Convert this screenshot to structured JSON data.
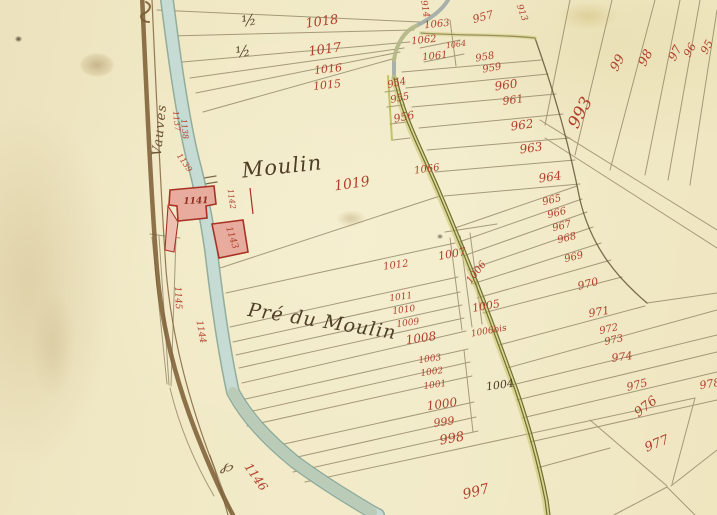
{
  "map": {
    "kind": "historical cadastral plan (manuscript)",
    "colors": {
      "paper": "#f0e8c5",
      "parcel_number_red": "#b1402c",
      "ink_brown": "#4e3e26",
      "river_blue": "#c3d9d1",
      "road_brown": "#7a5c33",
      "path_olive": "#6f7030",
      "building_pink": "#e7ac9d",
      "building_red": "#a93226"
    },
    "place_labels": {
      "moulin": "Moulin",
      "pre_du_moulin": "Pré du Moulin",
      "vauves": "Vauves"
    },
    "labels": [
      {
        "t": "Moulin",
        "x": 282,
        "y": 167,
        "r": -6,
        "s": 21,
        "c": "c-ink",
        "n": "place-label-moulin",
        "cls": "script"
      },
      {
        "t": "Pré du Moulin",
        "x": 322,
        "y": 322,
        "r": 9,
        "s": 19,
        "c": "c-ink",
        "n": "place-label-pre-du-moulin",
        "cls": "script"
      },
      {
        "t": "Vauves",
        "x": 160,
        "y": 130,
        "r": -84,
        "s": 13,
        "c": "c-brn",
        "n": "place-label-vauves",
        "cls": "script"
      },
      {
        "t": "½",
        "x": 249,
        "y": 21,
        "r": -10,
        "s": 15,
        "c": "c-ink",
        "n": "fraction-label"
      },
      {
        "t": "½",
        "x": 243,
        "y": 52,
        "r": -10,
        "s": 15,
        "c": "c-ink",
        "n": "fraction-label"
      },
      {
        "t": "℘",
        "x": 227,
        "y": 466,
        "r": 15,
        "s": 16,
        "c": "c-brn",
        "n": "flow-mark"
      },
      {
        "t": "1018",
        "x": 322,
        "y": 22,
        "r": -8,
        "s": 13,
        "c": "c-red",
        "n": "parcel-1018"
      },
      {
        "t": "1017",
        "x": 325,
        "y": 50,
        "r": -8,
        "s": 13,
        "c": "c-red",
        "n": "parcel-1017"
      },
      {
        "t": "1016",
        "x": 328,
        "y": 69,
        "r": -6,
        "s": 11,
        "c": "c-red",
        "n": "parcel-1016"
      },
      {
        "t": "1015",
        "x": 327,
        "y": 85,
        "r": -6,
        "s": 11,
        "c": "c-red",
        "n": "parcel-1015"
      },
      {
        "t": "914",
        "x": 424,
        "y": 9,
        "r": 80,
        "s": 9,
        "c": "c-red",
        "n": "parcel-914"
      },
      {
        "t": "913",
        "x": 521,
        "y": 13,
        "r": 70,
        "s": 9,
        "c": "c-red",
        "n": "parcel-913"
      },
      {
        "t": "957",
        "x": 483,
        "y": 17,
        "r": -15,
        "s": 11,
        "c": "c-red",
        "n": "parcel-957"
      },
      {
        "t": "1063",
        "x": 437,
        "y": 25,
        "r": -6,
        "s": 10,
        "c": "c-red",
        "n": "parcel-1063"
      },
      {
        "t": "1062",
        "x": 424,
        "y": 41,
        "r": -6,
        "s": 10,
        "c": "c-red",
        "n": "parcel-1062"
      },
      {
        "t": "1064",
        "x": 456,
        "y": 45,
        "r": -8,
        "s": 8,
        "c": "c-red",
        "n": "parcel-1064"
      },
      {
        "t": "1061",
        "x": 435,
        "y": 57,
        "r": -6,
        "s": 10,
        "c": "c-red",
        "n": "parcel-1061"
      },
      {
        "t": "954",
        "x": 397,
        "y": 84,
        "r": -12,
        "s": 10,
        "c": "c-red",
        "n": "parcel-954"
      },
      {
        "t": "955",
        "x": 400,
        "y": 99,
        "r": -12,
        "s": 10,
        "c": "c-red",
        "n": "parcel-955"
      },
      {
        "t": "956",
        "x": 404,
        "y": 117,
        "r": -12,
        "s": 11,
        "c": "c-red",
        "n": "parcel-956"
      },
      {
        "t": "958",
        "x": 485,
        "y": 58,
        "r": -10,
        "s": 10,
        "c": "c-red",
        "n": "parcel-958"
      },
      {
        "t": "959",
        "x": 492,
        "y": 69,
        "r": -10,
        "s": 10,
        "c": "c-red",
        "n": "parcel-959"
      },
      {
        "t": "960",
        "x": 506,
        "y": 85,
        "r": -8,
        "s": 12,
        "c": "c-red",
        "n": "parcel-960"
      },
      {
        "t": "961",
        "x": 513,
        "y": 100,
        "r": -8,
        "s": 11,
        "c": "c-red",
        "n": "parcel-961"
      },
      {
        "t": "962",
        "x": 522,
        "y": 125,
        "r": -8,
        "s": 12,
        "c": "c-red",
        "n": "parcel-962"
      },
      {
        "t": "963",
        "x": 531,
        "y": 148,
        "r": -8,
        "s": 12,
        "c": "c-red",
        "n": "parcel-963"
      },
      {
        "t": "964",
        "x": 550,
        "y": 177,
        "r": -8,
        "s": 12,
        "c": "c-red",
        "n": "parcel-964"
      },
      {
        "t": "965",
        "x": 552,
        "y": 201,
        "r": -14,
        "s": 10,
        "c": "c-red",
        "n": "parcel-965"
      },
      {
        "t": "966",
        "x": 557,
        "y": 214,
        "r": -14,
        "s": 10,
        "c": "c-red",
        "n": "parcel-966"
      },
      {
        "t": "967",
        "x": 562,
        "y": 227,
        "r": -14,
        "s": 10,
        "c": "c-red",
        "n": "parcel-967"
      },
      {
        "t": "968",
        "x": 567,
        "y": 239,
        "r": -14,
        "s": 10,
        "c": "c-red",
        "n": "parcel-968"
      },
      {
        "t": "969",
        "x": 574,
        "y": 258,
        "r": -14,
        "s": 10,
        "c": "c-red",
        "n": "parcel-969"
      },
      {
        "t": "970",
        "x": 588,
        "y": 284,
        "r": -14,
        "s": 11,
        "c": "c-red",
        "n": "parcel-970"
      },
      {
        "t": "971",
        "x": 599,
        "y": 312,
        "r": -10,
        "s": 11,
        "c": "c-red",
        "n": "parcel-971"
      },
      {
        "t": "972",
        "x": 609,
        "y": 330,
        "r": -12,
        "s": 10,
        "c": "c-red",
        "n": "parcel-972"
      },
      {
        "t": "973",
        "x": 614,
        "y": 341,
        "r": -12,
        "s": 10,
        "c": "c-red",
        "n": "parcel-973"
      },
      {
        "t": "974",
        "x": 622,
        "y": 357,
        "r": -8,
        "s": 11,
        "c": "c-red",
        "n": "parcel-974"
      },
      {
        "t": "975",
        "x": 637,
        "y": 385,
        "r": -14,
        "s": 11,
        "c": "c-red",
        "n": "parcel-975"
      },
      {
        "t": "976",
        "x": 646,
        "y": 407,
        "r": -38,
        "s": 13,
        "c": "c-red",
        "n": "parcel-976"
      },
      {
        "t": "977",
        "x": 657,
        "y": 444,
        "r": -22,
        "s": 13,
        "c": "c-red",
        "n": "parcel-977"
      },
      {
        "t": "978",
        "x": 710,
        "y": 384,
        "r": -10,
        "s": 11,
        "c": "c-red",
        "n": "parcel-978"
      },
      {
        "t": "993",
        "x": 581,
        "y": 113,
        "r": -62,
        "s": 17,
        "c": "c-red",
        "n": "parcel-993"
      },
      {
        "t": "99",
        "x": 618,
        "y": 63,
        "r": -62,
        "s": 13,
        "c": "c-red",
        "n": "parcel-99"
      },
      {
        "t": "98",
        "x": 646,
        "y": 58,
        "r": -62,
        "s": 13,
        "c": "c-red",
        "n": "parcel-98"
      },
      {
        "t": "97",
        "x": 675,
        "y": 53,
        "r": -62,
        "s": 12,
        "c": "c-red",
        "n": "parcel-97"
      },
      {
        "t": "96",
        "x": 690,
        "y": 50,
        "r": -62,
        "s": 11,
        "c": "c-red",
        "n": "parcel-96"
      },
      {
        "t": "95",
        "x": 707,
        "y": 47,
        "r": -62,
        "s": 11,
        "c": "c-red",
        "n": "parcel-95"
      },
      {
        "t": "1066",
        "x": 427,
        "y": 170,
        "r": -8,
        "s": 10,
        "c": "c-red",
        "n": "parcel-1066"
      },
      {
        "t": "1019",
        "x": 352,
        "y": 184,
        "r": -8,
        "s": 14,
        "c": "c-red",
        "n": "parcel-1019"
      },
      {
        "t": "1007",
        "x": 452,
        "y": 254,
        "r": -10,
        "s": 11,
        "c": "c-red",
        "n": "parcel-1007"
      },
      {
        "t": "1006",
        "x": 477,
        "y": 273,
        "r": -52,
        "s": 10,
        "c": "c-red",
        "n": "parcel-1006"
      },
      {
        "t": "1005",
        "x": 486,
        "y": 306,
        "r": -10,
        "s": 11,
        "c": "c-red",
        "n": "parcel-1005"
      },
      {
        "t": "1006bis",
        "x": 489,
        "y": 332,
        "r": -10,
        "s": 9,
        "c": "c-red",
        "n": "parcel-1006bis"
      },
      {
        "t": "1004",
        "x": 500,
        "y": 385,
        "r": -8,
        "s": 11,
        "c": "c-ink",
        "n": "parcel-1004"
      },
      {
        "t": "1012",
        "x": 396,
        "y": 266,
        "r": -8,
        "s": 10,
        "c": "c-red",
        "n": "parcel-1012"
      },
      {
        "t": "1011",
        "x": 401,
        "y": 298,
        "r": -8,
        "s": 9,
        "c": "c-red",
        "n": "parcel-1011"
      },
      {
        "t": "1010",
        "x": 404,
        "y": 311,
        "r": -8,
        "s": 9,
        "c": "c-red",
        "n": "parcel-1010"
      },
      {
        "t": "1009",
        "x": 408,
        "y": 324,
        "r": -8,
        "s": 9,
        "c": "c-red",
        "n": "parcel-1009"
      },
      {
        "t": "1008",
        "x": 421,
        "y": 338,
        "r": -8,
        "s": 12,
        "c": "c-red",
        "n": "parcel-1008"
      },
      {
        "t": "1003",
        "x": 430,
        "y": 360,
        "r": -8,
        "s": 9,
        "c": "c-red",
        "n": "parcel-1003"
      },
      {
        "t": "1002",
        "x": 432,
        "y": 373,
        "r": -8,
        "s": 9,
        "c": "c-red",
        "n": "parcel-1002"
      },
      {
        "t": "1001",
        "x": 435,
        "y": 386,
        "r": -8,
        "s": 9,
        "c": "c-red",
        "n": "parcel-1001"
      },
      {
        "t": "1000",
        "x": 442,
        "y": 404,
        "r": -8,
        "s": 12,
        "c": "c-red",
        "n": "parcel-1000"
      },
      {
        "t": "999",
        "x": 444,
        "y": 422,
        "r": -8,
        "s": 11,
        "c": "c-red",
        "n": "parcel-999"
      },
      {
        "t": "998",
        "x": 452,
        "y": 439,
        "r": -10,
        "s": 13,
        "c": "c-red",
        "n": "parcel-998"
      },
      {
        "t": "997",
        "x": 476,
        "y": 492,
        "r": -14,
        "s": 14,
        "c": "c-red",
        "n": "parcel-997"
      },
      {
        "t": "1146",
        "x": 256,
        "y": 477,
        "r": 55,
        "s": 12,
        "c": "c-red",
        "n": "parcel-1146"
      },
      {
        "t": "1141",
        "x": 196,
        "y": 202,
        "r": -2,
        "s": 9,
        "c": "c-dred",
        "n": "building-1141"
      },
      {
        "t": "1142",
        "x": 231,
        "y": 199,
        "r": 82,
        "s": 8,
        "c": "c-red",
        "n": "building-1142"
      },
      {
        "t": "1143",
        "x": 231,
        "y": 238,
        "r": 72,
        "s": 9,
        "c": "c-red",
        "n": "building-1143"
      },
      {
        "t": "1137",
        "x": 176,
        "y": 121,
        "r": 84,
        "s": 8,
        "c": "c-red",
        "n": "parcel-1137"
      },
      {
        "t": "1138",
        "x": 184,
        "y": 129,
        "r": 84,
        "s": 8,
        "c": "c-red",
        "n": "parcel-1138"
      },
      {
        "t": "1139",
        "x": 184,
        "y": 163,
        "r": 55,
        "s": 8,
        "c": "c-red",
        "n": "parcel-1139"
      },
      {
        "t": "1145",
        "x": 177,
        "y": 298,
        "r": 87,
        "s": 9,
        "c": "c-red",
        "n": "parcel-1145"
      },
      {
        "t": "1144",
        "x": 200,
        "y": 332,
        "r": 80,
        "s": 9,
        "c": "c-red",
        "n": "parcel-1144"
      }
    ]
  }
}
